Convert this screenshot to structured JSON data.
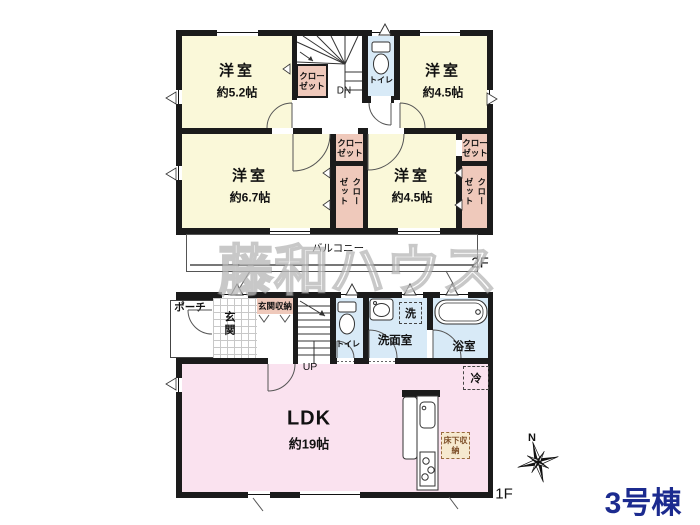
{
  "building_label": "3号棟",
  "watermark": "藤和ハウス",
  "f2": {
    "floor_label": "2F",
    "balcony": "バルコニー",
    "dn": "DN",
    "toilet": "トイレ",
    "closet": "クローゼット",
    "room_nw": {
      "name": "洋室",
      "size": "約5.2帖"
    },
    "room_ne": {
      "name": "洋室",
      "size": "約4.5帖"
    },
    "room_sw": {
      "name": "洋室",
      "size": "約6.7帖"
    },
    "room_se": {
      "name": "洋室",
      "size": "約4.5帖"
    }
  },
  "f1": {
    "floor_label": "1F",
    "porch": "ポーチ",
    "entrance": "玄関",
    "entrance_storage": "玄関収納",
    "up": "UP",
    "toilet": "トイレ",
    "washer": "洗",
    "washroom": "洗面室",
    "bathroom": "浴室",
    "ldk": {
      "name": "LDK",
      "size": "約19帖"
    },
    "fridge": "冷",
    "underfloor_storage": "床下収納",
    "compass_north": "N"
  },
  "colors": {
    "wall": "#1b1b1b",
    "room_yellow": "#FAF8D9",
    "closet_pink": "#EFC9BB",
    "water_blue": "#D8EAF7",
    "ldk_pink": "#FAE2EF",
    "accent_navy": "#1c2b8f",
    "underfloor_bg": "#F6E9CF",
    "underfloor_text": "#7d4e28"
  }
}
